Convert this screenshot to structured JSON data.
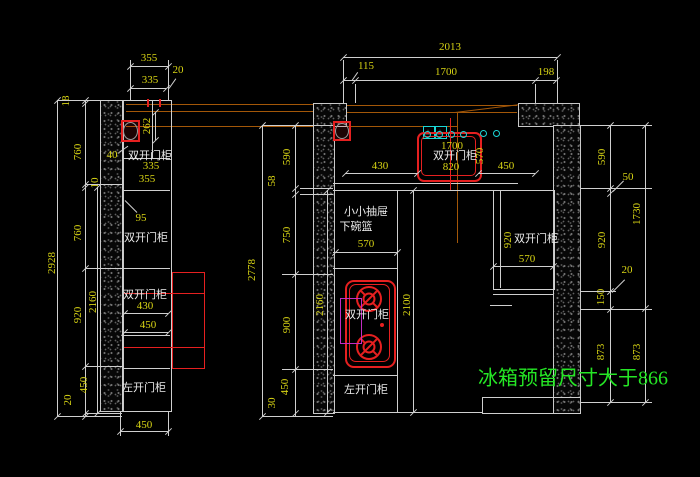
{
  "drawing": {
    "note": "冰箱预留尺寸大于866",
    "left_elevation": {
      "top_dims": {
        "w355": "355",
        "w20": "20",
        "w335": "335"
      },
      "left_dims": {
        "total": "2928",
        "s18": "18",
        "s760a": "760",
        "s10": "10",
        "s760b": "760",
        "s920": "920",
        "s450": "450",
        "s20": "20",
        "inner": "2160"
      },
      "body": {
        "d262": "262",
        "lead40": "40",
        "cab1": "双开门柜",
        "m335": "335",
        "m355": "355",
        "lead95": "95",
        "cab2": "双开门柜",
        "cab3": "双开门柜",
        "d430": "430",
        "d450": "450",
        "cab4": "左开门柜",
        "base": "450"
      }
    },
    "plan": {
      "top_dims": {
        "total": "2013",
        "w115": "115",
        "w1700": "1700",
        "w198": "198"
      },
      "left_chain": {
        "total": "2778",
        "s590": "590",
        "s58": "58",
        "s750": "750",
        "s900": "900",
        "s450": "450",
        "s30": "30"
      },
      "right_chain": {
        "s590": "590",
        "s50": "50",
        "s920": "920",
        "s20": "20",
        "s150": "150",
        "s873": "873",
        "total": "1730",
        "b873": "873"
      },
      "counter": {
        "d430": "430",
        "d450": "450"
      },
      "sink": {
        "d1700": "1700",
        "label": "双开门柜",
        "d820": "820",
        "d570": "570"
      },
      "basket": {
        "l1": "小小抽屉",
        "l2": "下碗篮",
        "d570": "570"
      },
      "mid": {
        "v2160": "2160",
        "v2100": "2100",
        "stove": "双开门柜",
        "bottom": "左开门柜"
      },
      "right_cab": {
        "label": "双开门柜",
        "d920": "920",
        "d570": "570"
      }
    },
    "colors": {
      "background": "#000000",
      "lines": "#cfcfcf",
      "dims": "#d8d414",
      "labels": "#ebebeb",
      "red": "#e62020",
      "cyan": "#1bd6d6",
      "magenta": "#c32cc3",
      "orange": "#a35708",
      "green": "#25e625"
    }
  }
}
